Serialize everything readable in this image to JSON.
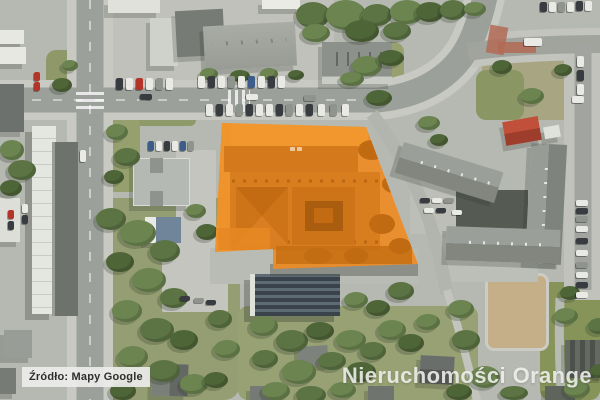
{
  "source_label": {
    "text": "Źródło: Mapy Google",
    "bg": "rgba(236,236,233,0.93)",
    "color": "#2e2e2e"
  },
  "watermark": {
    "text": "Nieruchomości Orange",
    "color": "rgba(242,243,240,0.87)"
  },
  "overlay": {
    "label": "highlighted-property-parcel",
    "fill": "#EE8C26",
    "opacity": 0.93,
    "points": "222,123 366,127 418,264 273,269 273,249 215,252"
  }
}
